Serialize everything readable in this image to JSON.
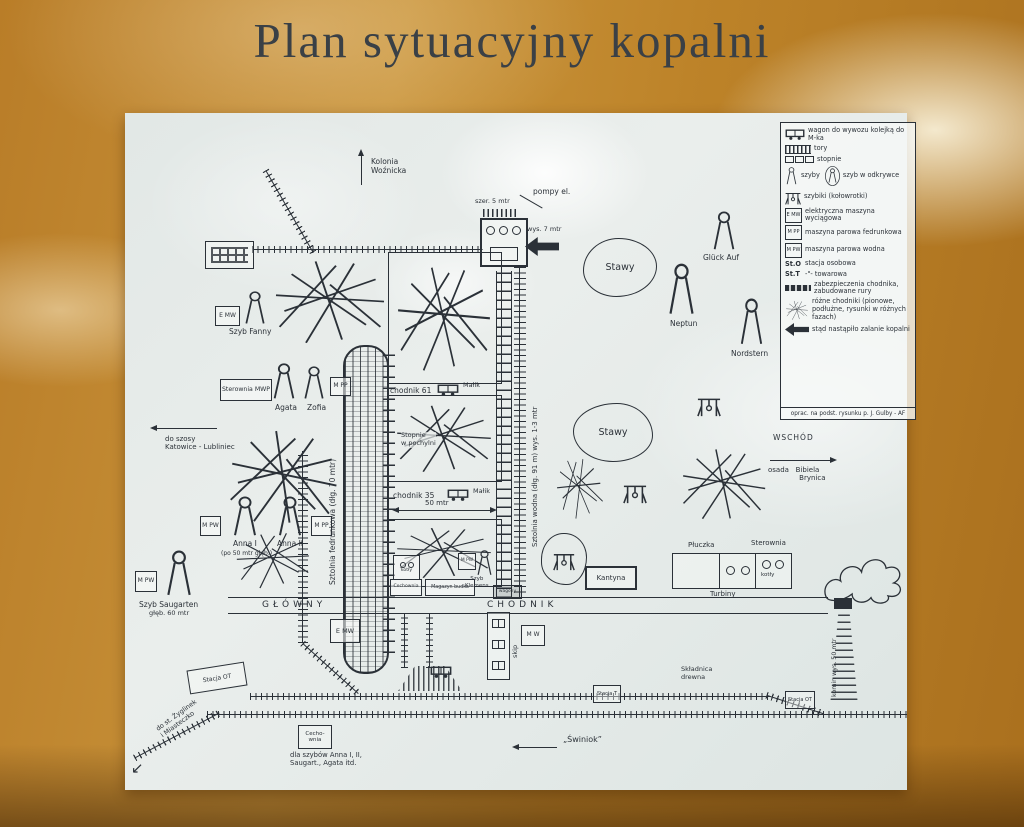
{
  "title": "Plan sytuacyjny kopalni",
  "legend": {
    "items": [
      {
        "label": "wagon do wywozu kolejką do M-ka"
      },
      {
        "label": "tory"
      },
      {
        "label": "stopnie"
      },
      {
        "label": "szyby"
      },
      {
        "label": "szyb w odkrywce"
      },
      {
        "label": "szybiki (kołowrotki)"
      },
      {
        "key": "E MW",
        "label": "elektryczna maszyna wyciągowa"
      },
      {
        "key": "M PP",
        "label": "maszyna parowa fedrunkowa"
      },
      {
        "key": "M PW",
        "label": "maszyna parowa wodna"
      },
      {
        "key": "St.O",
        "label": "stacja osobowa"
      },
      {
        "key": "St.T",
        "label": "-\"- towarowa"
      },
      {
        "label": "zabezpieczenia chodnika, zabudowane rury"
      },
      {
        "label": "różne chodniki (pionowe, podłużne, rysunki w różnych fazach)"
      },
      {
        "label": "stąd nastąpiło zalanie kopalni"
      }
    ],
    "caption": "oprac. na podst. rysunku p. J. Gulby - AF"
  },
  "map": {
    "kolonia": "Kolonia\nWoźnicka",
    "pompy": "pompy el.",
    "szer5": "szer. 5 mtr",
    "wys7": "wys. 7 mtr",
    "stawy1": "Stawy",
    "stawy2": "Stawy",
    "gluck": "Glück Auf",
    "neptun": "Neptun",
    "nordstern": "Nordstern",
    "fanny_box": "E MW",
    "fanny": "Szyb Fanny",
    "sterownia_mwp": "Sterownia MWP",
    "agata": "Agata",
    "zofia": "Zofia",
    "zofia_box": "M PP",
    "do_szosy": "do szosy\nKatowice - Lubliniec",
    "anna1_box": "M PW",
    "anna1": "Anna I",
    "anna1_sub": "(po 50 mtr głęb.)",
    "anna2": "Anna II",
    "anna2_box": "M PP",
    "saugarten_box": "M PW",
    "saugarten": "Szyb Saugarten",
    "saugarten_sub": "głęb. 60 mtr",
    "sztolnia_fedrunkowa": "Sztolnia fedrunkowa (dłg. 70 mtr)",
    "chodnik61": "chodnik 61",
    "malik1": "Małik",
    "stopnie_pochylni": "Stopnie\nw pochylni",
    "chodnik35": "chodnik 35",
    "malik2": "Małik",
    "mtr50": "50 mtr",
    "sztolnia_wodna": "Sztolnia wodna (dłg. 91 m) wys. 1-3 mtr",
    "glowny": "GŁÓWNY",
    "chodnik": "CHODNIK",
    "kotly_small": "kotły",
    "cechownia_small": "Cechownia",
    "magazyn": "Magazyn budka",
    "klemens_box": "M PW",
    "klemens": "Szyb\nKlemens",
    "wagony": "wagony",
    "emw_box": "E MW",
    "mw_box": "M W",
    "skip": "skip",
    "kantyna": "Kantyna",
    "pluczka": "Płuczka",
    "sterownia": "Sterownia",
    "kotly": "kotły",
    "turbiny": "Turbiny",
    "wschod": "WSCHÓD",
    "osada": "osada   Bibiela\n              Brynica",
    "stacja_ot1": "Stacja OT",
    "stacja_t": "Stacja T",
    "skladnica": "Składnica\ndrewna",
    "stacja_ot2": "Stacja OT",
    "swiniok": "„Świniok”",
    "cechownia2": "Cecho-\nwnia",
    "cechownia2_sub": "dla szybów Anna I, II,\nSaugart., Agata itd.",
    "do_stacji": "do st. Żyglinek\ni Miasteczko",
    "komin": "komin wys. 50 mtr"
  }
}
